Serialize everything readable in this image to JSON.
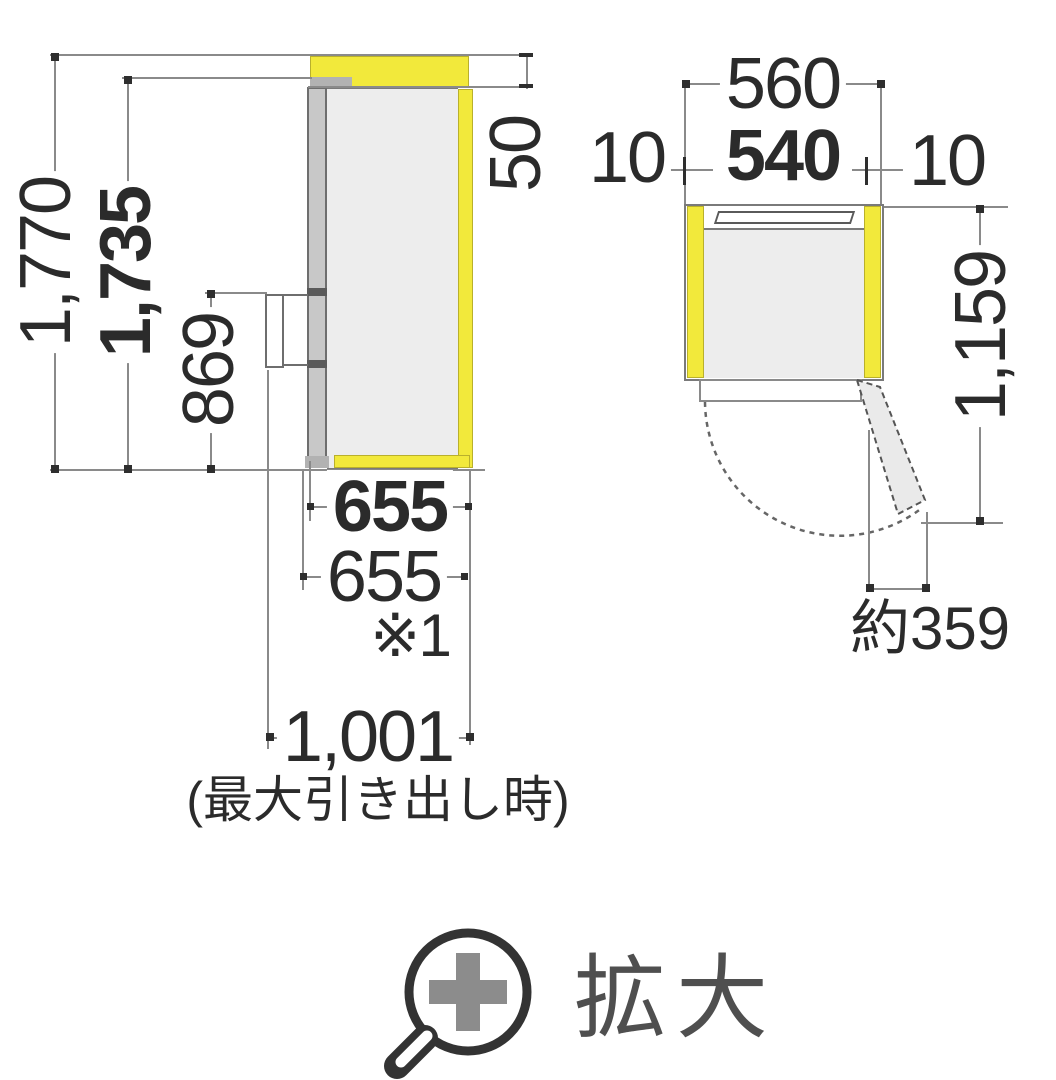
{
  "colors": {
    "clearance_yellow": "#F2E93B",
    "cabinet_gray": "#ededed",
    "door_gray": "#c8c8c8",
    "dimension_line_gray": "#8a8a8a",
    "text_dark": "#2b2b2b",
    "icon_gray": "#8c8c8c"
  },
  "side_view": {
    "total_height": "1,770",
    "body_height": "1,735",
    "handle_bottom_height": "869",
    "top_clearance": "50",
    "depth_with_door": "655",
    "depth_alt": "655",
    "depth_alt_note": "※1",
    "max_pullout_depth": "1,001",
    "max_pullout_caption": "(最大引き出し時)"
  },
  "top_view": {
    "total_width": "560",
    "left_clearance": "10",
    "body_width": "540",
    "right_clearance": "10",
    "open_door_depth": "1,159",
    "door_open_protrusion": "約359"
  },
  "zoom_button": {
    "label": "拡大",
    "icon": "magnifier-plus-icon"
  }
}
